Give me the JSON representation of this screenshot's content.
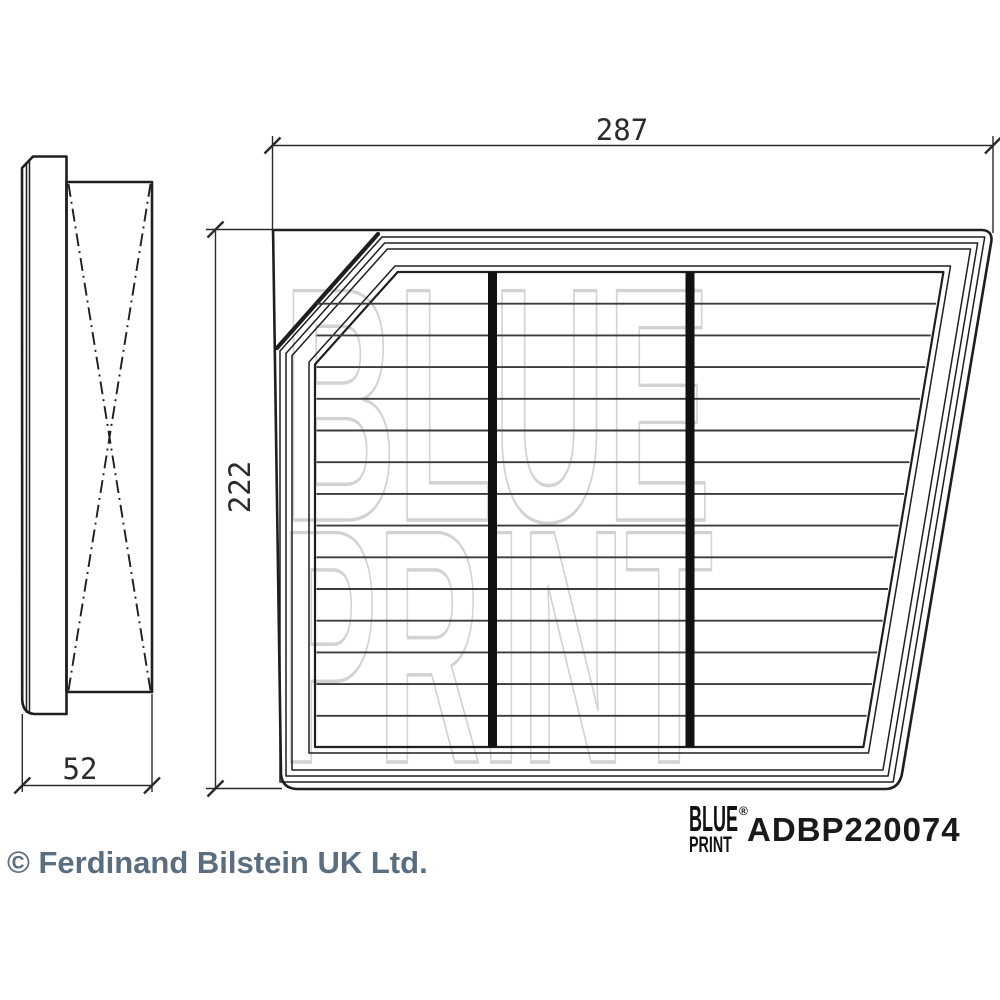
{
  "watermark": {
    "line1": "BLUE",
    "line2": "PRINT"
  },
  "views": {
    "top_view": {
      "width_label": "287",
      "height_label": "222"
    },
    "side_view": {
      "depth_label": "52"
    }
  },
  "brand": {
    "logo_top": "BLUE",
    "logo_bottom": "PRINT",
    "registered_mark": "®",
    "part_number": "ADBP220074"
  },
  "footer": {
    "copyright": "© Ferdinand Bilstein UK Ltd."
  },
  "colors": {
    "line": "#1f1f1f",
    "pleat": "#3c3c3c",
    "watermark": "#d2d2d2",
    "dimension": "#2a2a2a",
    "copyright_text": "#5b6e7f"
  }
}
